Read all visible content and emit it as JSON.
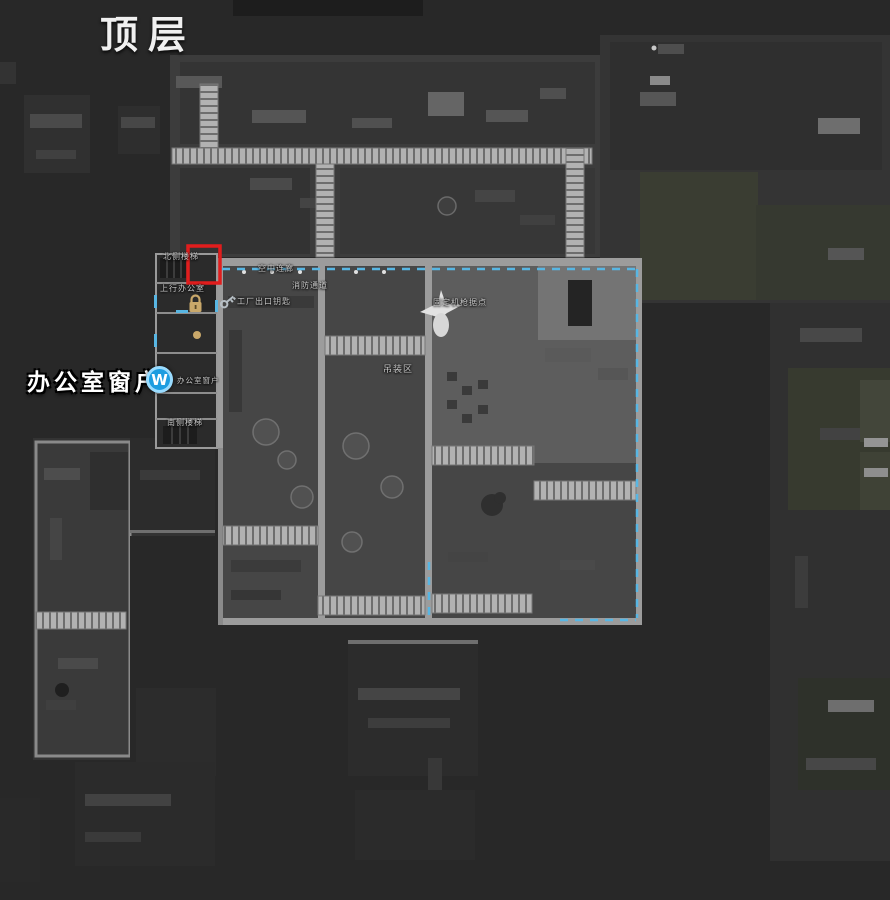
{
  "title": "顶层",
  "annotation": {
    "text": "办公室窗户",
    "marker_letter": "W"
  },
  "labels": {
    "north_stairs": "北侧楼梯",
    "office_up": "上行办公室",
    "sky_corridor": "空中连廊",
    "fire_passage": "消防通道",
    "factory_exit_key": "工厂出口钥匙",
    "mg_position": "固定机枪据点",
    "hoist_area": "吊装区",
    "office_window": "办公室窗户",
    "south_stairs": "南侧楼梯"
  },
  "icons": {
    "lock": "gold-padlock",
    "small_lock": "small-gold-padlock",
    "key": "silver-key",
    "marker": "blue-circle-W",
    "highlight": "red-rectangle"
  },
  "colors": {
    "background": "#282828",
    "highlight_red": "#e11d1d",
    "dashed_cyan": "#58b6e3",
    "marker_blue": "#1d9de0",
    "marker_ring": "#9adcff",
    "lock_gold": "#c9a86a",
    "key_silver": "#b6bec4",
    "title_text": "#f0f0f0",
    "label_text": "#c9c9c9",
    "catwalk_light": "#b2b2b2",
    "wall_light": "#9c9c9c"
  }
}
